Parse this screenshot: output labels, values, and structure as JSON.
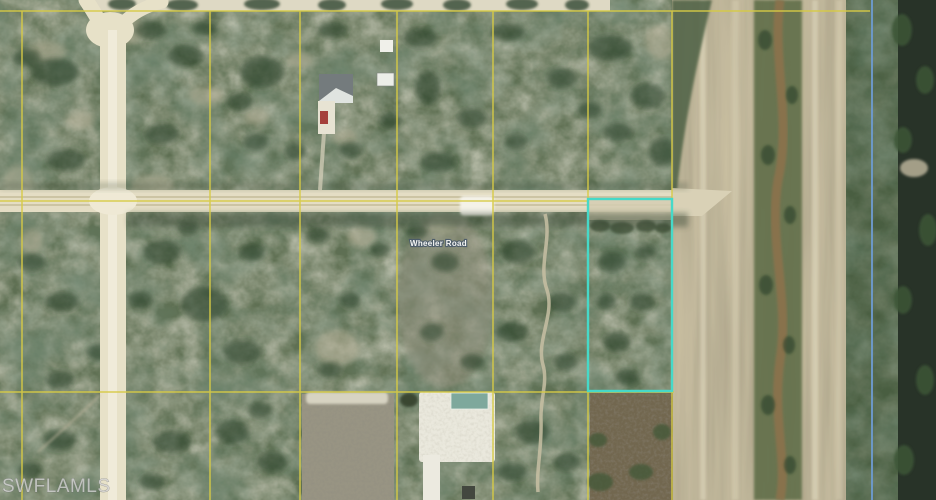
{
  "map": {
    "street_label": "Wheeler Road",
    "watermark": "SWFLAMLS",
    "colors": {
      "parcel_grid_yellow": "#d6c93e",
      "highlight_teal": "#3fd8c6",
      "boundary_blue": "#4d80c4",
      "vegetation_green": "#586a4c",
      "dirt_road_cream": "#e7e0c6",
      "farm_strip_tan": "#c6bc9d",
      "canal_water_dark": "#202b20",
      "sand_white": "#eae8dc",
      "watermark_gray": "#d2d2d2"
    }
  }
}
